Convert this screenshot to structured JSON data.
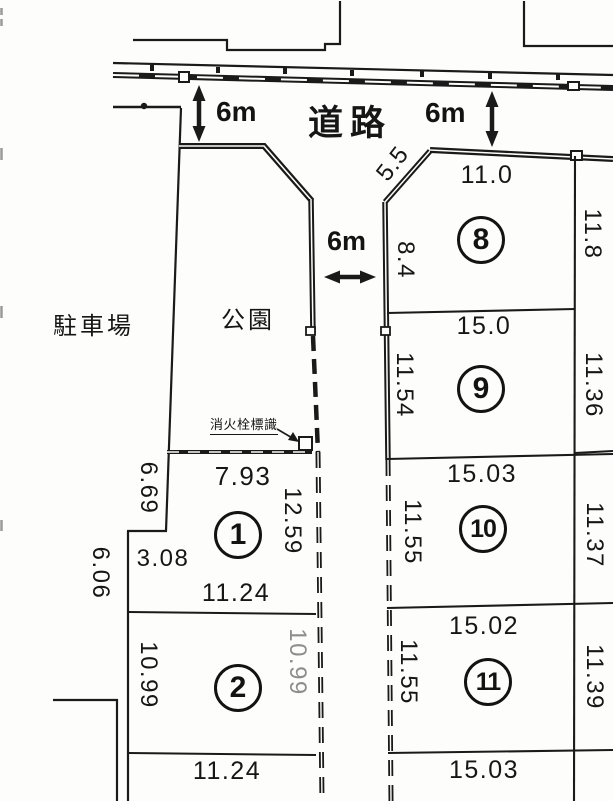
{
  "labels": {
    "road": "道路",
    "park": "公園",
    "parking": "駐車場",
    "fire_hydrant_sign": "消火栓標識"
  },
  "road_widths": {
    "top_left": "6m",
    "top_right": "6m",
    "center": "6m"
  },
  "diagonal_dim": "5.5",
  "plots": [
    {
      "no": "1",
      "top": "7.93",
      "left_upper": "6.69",
      "step": "3.08",
      "outer_left": "6.06",
      "right": "12.59",
      "bottom": "11.24"
    },
    {
      "no": "2",
      "left": "10.99",
      "right": "10.99",
      "bottom": "11.24"
    },
    {
      "no": "8",
      "top": "11.0",
      "left": "8.4",
      "right": "11.8"
    },
    {
      "no": "9",
      "top": "15.0",
      "left": "11.54",
      "right": "11.36"
    },
    {
      "no": "10",
      "top": "15.03",
      "left": "11.55",
      "right": "11.37"
    },
    {
      "no": "11",
      "top": "15.02",
      "left": "11.55",
      "right": "11.39",
      "bottom": "15.03"
    }
  ],
  "colors": {
    "ink": "#1a1a1a",
    "paper": "#fdfdfb",
    "faded": "#8d8d8d"
  }
}
